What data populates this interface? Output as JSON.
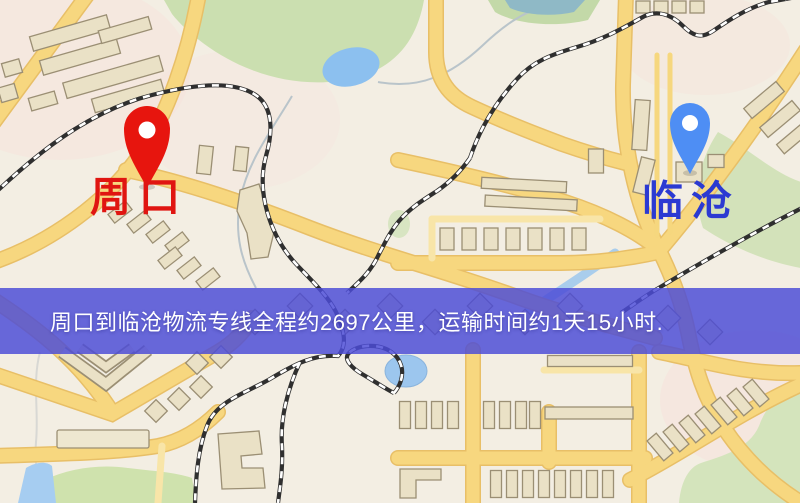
{
  "page": {
    "width": 800,
    "height": 503,
    "kind": "logistics-route-map"
  },
  "map": {
    "origin": {
      "name": "周口",
      "pin_color": "#e7150e",
      "label_color": "#e01511"
    },
    "destination": {
      "name": "临沧",
      "pin_color": "#4e8ef4",
      "label_color": "#2b3ad2"
    },
    "banner": {
      "text": "周口到临沧物流专线全程约2697公里，运输时间约1天15小时.",
      "distance_km": "2697",
      "duration": "1天15小时",
      "background_color": "#4c4cd6",
      "text_color": "#ffffff"
    },
    "palette": {
      "background": "#f3eee3",
      "road": "#f7d77f",
      "road_casing": "#e8bf67",
      "building": "#eae1c6",
      "park": "#cbdfb0",
      "water": "#9cc6ee",
      "railway": "#2f2f2f"
    }
  }
}
